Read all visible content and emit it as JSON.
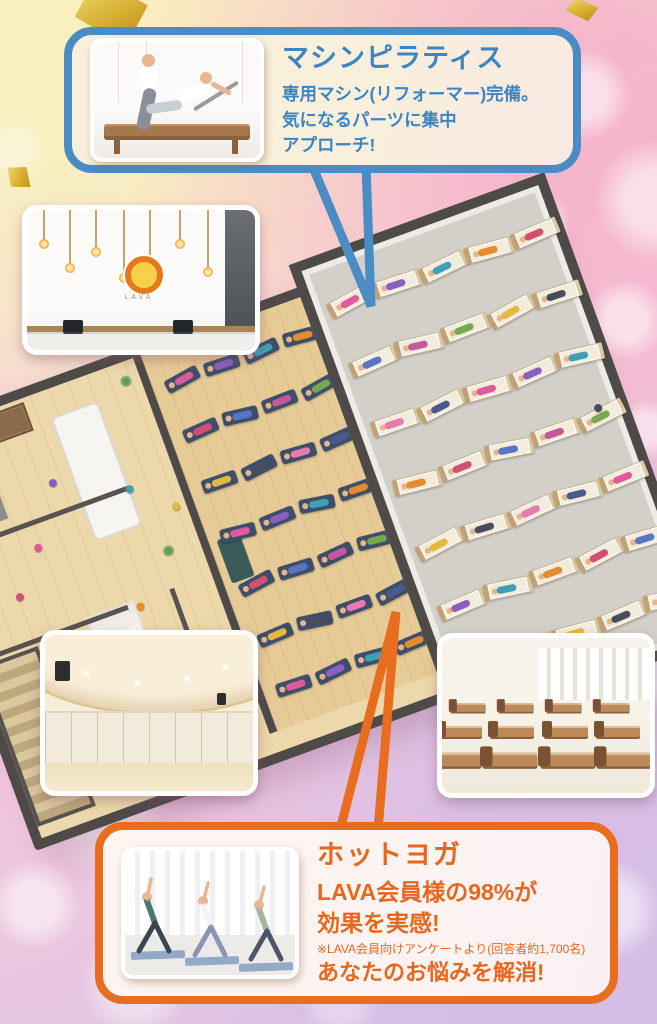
{
  "theme": {
    "blue": "#4a8cc4",
    "orange": "#e96d1e",
    "gold_confetti": "#d4ab2e",
    "callout_blue_bg": "#f9f0dc",
    "callout_orange_bg": "#fdf4f6"
  },
  "pilates_callout": {
    "title": "マシンピラティス",
    "line1": "専用マシン(リフォーマー)完備。",
    "line2": "気になるパーツに集中",
    "line3": "アプローチ!"
  },
  "hotyoga_callout": {
    "title": "ホットヨガ",
    "line1": "LAVA会員様の98%が",
    "line2": "効果を実感!",
    "note": "※LAVA会員向けアンケートより(回答者約1,700名)",
    "line3": "あなたのお悩みを解消!"
  },
  "lobby_photo": {
    "logo_text": "LAVA"
  },
  "floorplan": {
    "hot_yoga_room": {
      "name": "hot-yoga-studio",
      "mat_rows": 7,
      "mat_cols": 4,
      "mat_color": "#3d4e6a",
      "floor_color": "#e6cb96"
    },
    "machine_room": {
      "name": "machine-pilates-room",
      "bed_rows": 7,
      "bed_cols": 5,
      "bed_color": "#f2ecdc",
      "floor_color": "#d3d0ca"
    },
    "lobby": {
      "name": "lobby-lockers-showers"
    },
    "person_colors": [
      "#e05a9b",
      "#8a5fc0",
      "#3f9fb5",
      "#e88a2e",
      "#d14f72",
      "#5a74c4",
      "#c4589a",
      "#76a94f",
      "#e3b93f",
      "#474d5c",
      "#e87ab0",
      "#4a5a8a"
    ]
  }
}
